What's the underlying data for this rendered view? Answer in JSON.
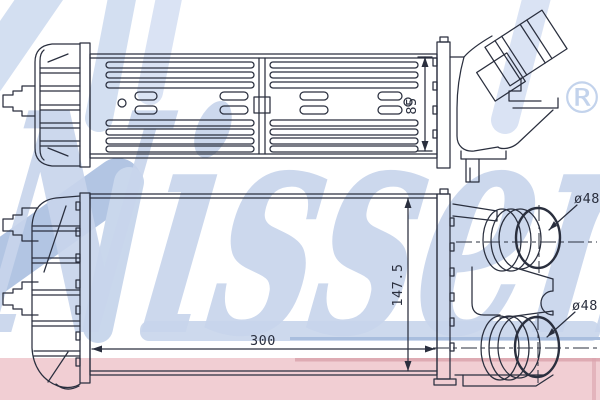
{
  "brand": {
    "watermark_text": "Nissens",
    "registered_mark": "®"
  },
  "dimensions": {
    "core_depth": "85",
    "core_height": "147.5",
    "core_width": "300",
    "upper_port_diameter": "ø48",
    "lower_port_diameter": "ø48"
  },
  "colors": {
    "line": "#2a2f3e",
    "watermark_blue": "#c8d5ec",
    "watermark_blue_dark": "#aabfe1",
    "underline_band_blue": "#cdd9ed",
    "underline_band_edge": "#a9bede",
    "brand_band_pink": "#f1ced3",
    "brand_band_pink_edge": "#dba4ad"
  }
}
